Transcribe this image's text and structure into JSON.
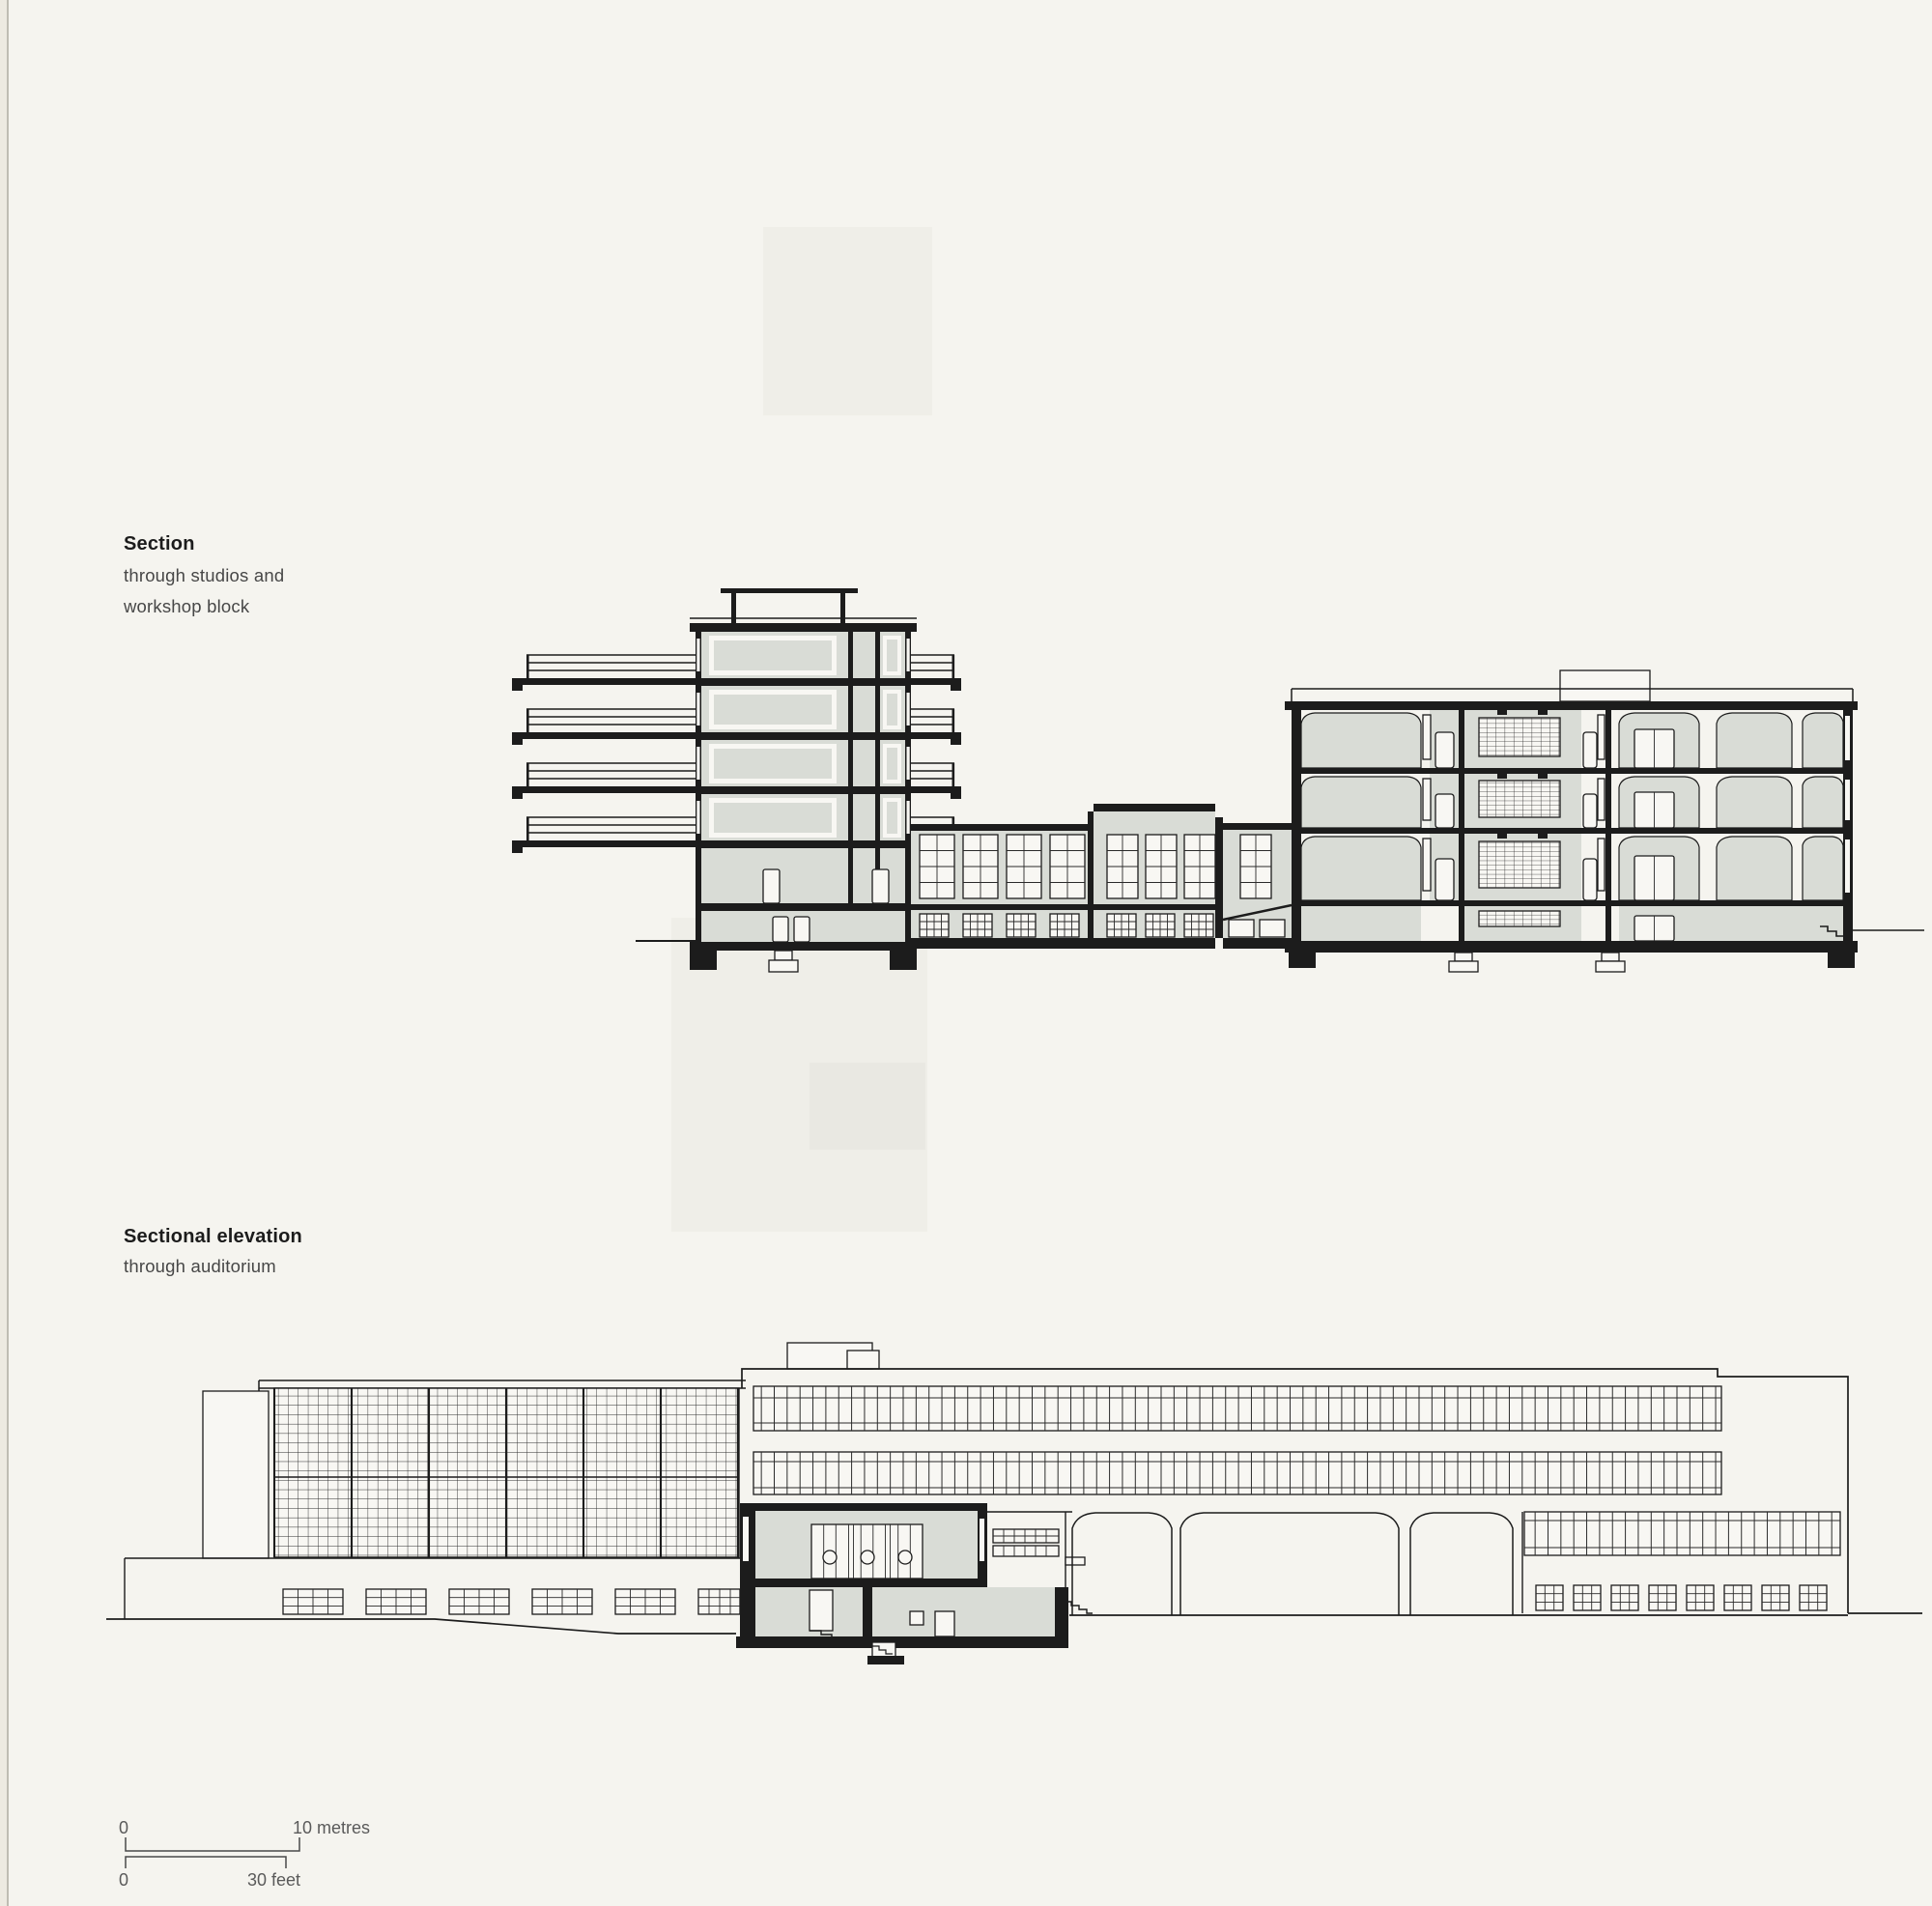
{
  "page": {
    "description": "Book page with two architectural drawings (building section and sectional elevation) and a graphic scale bar",
    "background_color": "#f5f4ef",
    "ink_color": "#1c1c1c",
    "section_cut_fill_color": "#d9dcd6"
  },
  "captions": {
    "section": {
      "title": "Section",
      "subtitle_line1": "through studios and",
      "subtitle_line2": "workshop block"
    },
    "sectional_elevation": {
      "title": "Sectional elevation",
      "subtitle_line1": "through auditorium"
    }
  },
  "scale_bar": {
    "metres": {
      "start_label": "0",
      "end_label": "10 metres"
    },
    "feet": {
      "start_label": "0",
      "end_label": "30 feet"
    }
  }
}
